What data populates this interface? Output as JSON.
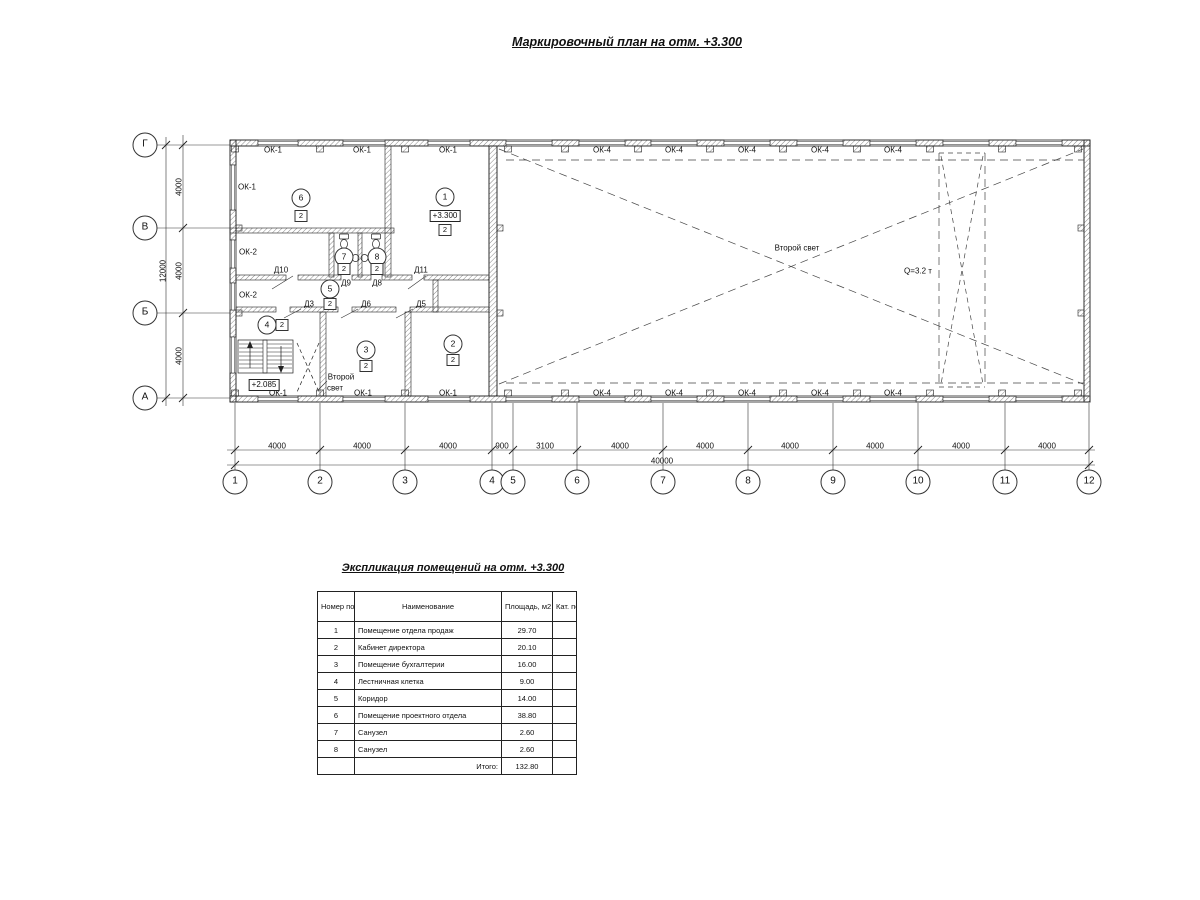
{
  "titles": {
    "plan": "Маркировочный план на отм. +3.300",
    "table": "Экспликация помещений на отм. +3.300"
  },
  "plan": {
    "cols": [
      {
        "n": "1",
        "x": 235
      },
      {
        "n": "2",
        "x": 320
      },
      {
        "n": "3",
        "x": 405
      },
      {
        "n": "4",
        "x": 492
      },
      {
        "n": "5",
        "x": 513
      },
      {
        "n": "6",
        "x": 577
      },
      {
        "n": "7",
        "x": 663
      },
      {
        "n": "8",
        "x": 748
      },
      {
        "n": "9",
        "x": 833
      },
      {
        "n": "10",
        "x": 918
      },
      {
        "n": "11",
        "x": 1005
      },
      {
        "n": "12",
        "x": 1089
      }
    ],
    "rows": [
      {
        "n": "Г",
        "y": 145
      },
      {
        "n": "В",
        "y": 228
      },
      {
        "n": "Б",
        "y": 313
      },
      {
        "n": "А",
        "y": 398
      }
    ],
    "dims_bottom": [
      {
        "t": "4000",
        "x": 277
      },
      {
        "t": "4000",
        "x": 362
      },
      {
        "t": "4000",
        "x": 448
      },
      {
        "t": "900",
        "x": 502
      },
      {
        "t": "3100",
        "x": 545
      },
      {
        "t": "4000",
        "x": 620
      },
      {
        "t": "4000",
        "x": 705
      },
      {
        "t": "4000",
        "x": 790
      },
      {
        "t": "4000",
        "x": 875
      },
      {
        "t": "4000",
        "x": 961
      },
      {
        "t": "4000",
        "x": 1047
      }
    ],
    "dim_total_bottom": {
      "t": "40000",
      "x": 662,
      "y": 461
    },
    "dims_left": [
      {
        "t": "4000",
        "y": 187
      },
      {
        "t": "4000",
        "y": 271
      },
      {
        "t": "4000",
        "y": 356
      }
    ],
    "dim_total_left": {
      "t": "12000",
      "y": 271
    },
    "windows": [
      {
        "t": "ОК-1",
        "x": 273,
        "y": 150
      },
      {
        "t": "ОК-1",
        "x": 362,
        "y": 150
      },
      {
        "t": "ОК-1",
        "x": 448,
        "y": 150
      },
      {
        "t": "ОК-1",
        "x": 247,
        "y": 187
      },
      {
        "t": "ОК-2",
        "x": 248,
        "y": 252
      },
      {
        "t": "ОК-2",
        "x": 248,
        "y": 295
      },
      {
        "t": "ОК-1",
        "x": 278,
        "y": 393
      },
      {
        "t": "ОК-1",
        "x": 363,
        "y": 393
      },
      {
        "t": "ОК-1",
        "x": 448,
        "y": 393
      },
      {
        "t": "ОК-4",
        "x": 602,
        "y": 150
      },
      {
        "t": "ОК-4",
        "x": 674,
        "y": 150
      },
      {
        "t": "ОК-4",
        "x": 747,
        "y": 150
      },
      {
        "t": "ОК-4",
        "x": 820,
        "y": 150
      },
      {
        "t": "ОК-4",
        "x": 893,
        "y": 150
      },
      {
        "t": "ОК-4",
        "x": 602,
        "y": 393
      },
      {
        "t": "ОК-4",
        "x": 674,
        "y": 393
      },
      {
        "t": "ОК-4",
        "x": 747,
        "y": 393
      },
      {
        "t": "ОК-4",
        "x": 820,
        "y": 393
      },
      {
        "t": "ОК-4",
        "x": 893,
        "y": 393
      }
    ],
    "doors": [
      {
        "t": "Д10",
        "x": 281,
        "y": 270
      },
      {
        "t": "Д9",
        "x": 346,
        "y": 283
      },
      {
        "t": "Д8",
        "x": 377,
        "y": 283
      },
      {
        "t": "Д11",
        "x": 421,
        "y": 270
      },
      {
        "t": "Д3",
        "x": 309,
        "y": 304
      },
      {
        "t": "Д6",
        "x": 366,
        "y": 304
      },
      {
        "t": "Д5",
        "x": 421,
        "y": 304
      }
    ],
    "rooms": [
      {
        "n": "1",
        "x": 445,
        "y": 197,
        "cat": "2",
        "cx": 445,
        "cy": 230
      },
      {
        "n": "2",
        "x": 453,
        "y": 344,
        "cat": "2",
        "cx": 453,
        "cy": 360
      },
      {
        "n": "3",
        "x": 366,
        "y": 350,
        "cat": "2",
        "cx": 366,
        "cy": 366
      },
      {
        "n": "4",
        "x": 267,
        "y": 325,
        "cat": "2",
        "cx": 282,
        "cy": 325
      },
      {
        "n": "5",
        "x": 330,
        "y": 289,
        "cat": "2",
        "cx": 330,
        "cy": 304
      },
      {
        "n": "6",
        "x": 301,
        "y": 198,
        "cat": "2",
        "cx": 301,
        "cy": 216
      },
      {
        "n": "7",
        "x": 344,
        "y": 257,
        "cat": "2",
        "cx": 344,
        "cy": 269
      },
      {
        "n": "8",
        "x": 377,
        "y": 257,
        "cat": "2",
        "cx": 377,
        "cy": 269
      }
    ],
    "elevations": [
      {
        "t": "+3.300",
        "x": 445,
        "y": 216
      },
      {
        "t": "+2.085",
        "x": 264,
        "y": 385
      }
    ],
    "notes": [
      {
        "t": "Второй свет",
        "x": 797,
        "y": 248,
        "name": "second-light-label"
      },
      {
        "t": "Q=3.2 т",
        "x": 918,
        "y": 271,
        "name": "crane-capacity-label"
      },
      {
        "t": "Второй",
        "x": 341,
        "y": 377,
        "name": "second-light-stair-label-line1"
      },
      {
        "t": "свет",
        "x": 335,
        "y": 388,
        "name": "second-light-stair-label-line2"
      }
    ]
  },
  "table": {
    "headers": {
      "num": "Номер помещ.",
      "name": "Наименование",
      "area": "Площадь, м2",
      "cat": "Кат. пом."
    },
    "rows": [
      {
        "num": "1",
        "name": "Помещение отдела продаж",
        "area": "29.70",
        "cat": ""
      },
      {
        "num": "2",
        "name": "Кабинет директора",
        "area": "20.10",
        "cat": ""
      },
      {
        "num": "3",
        "name": "Помещение бухгалтерии",
        "area": "16.00",
        "cat": ""
      },
      {
        "num": "4",
        "name": "Лестничная клетка",
        "area": "9.00",
        "cat": ""
      },
      {
        "num": "5",
        "name": "Коридор",
        "area": "14.00",
        "cat": ""
      },
      {
        "num": "6",
        "name": "Помещение проектного отдела",
        "area": "38.80",
        "cat": ""
      },
      {
        "num": "7",
        "name": "Санузел",
        "area": "2.60",
        "cat": ""
      },
      {
        "num": "8",
        "name": "Санузел",
        "area": "2.60",
        "cat": ""
      }
    ],
    "total_label": "Итого:",
    "total_area": "132.80"
  }
}
